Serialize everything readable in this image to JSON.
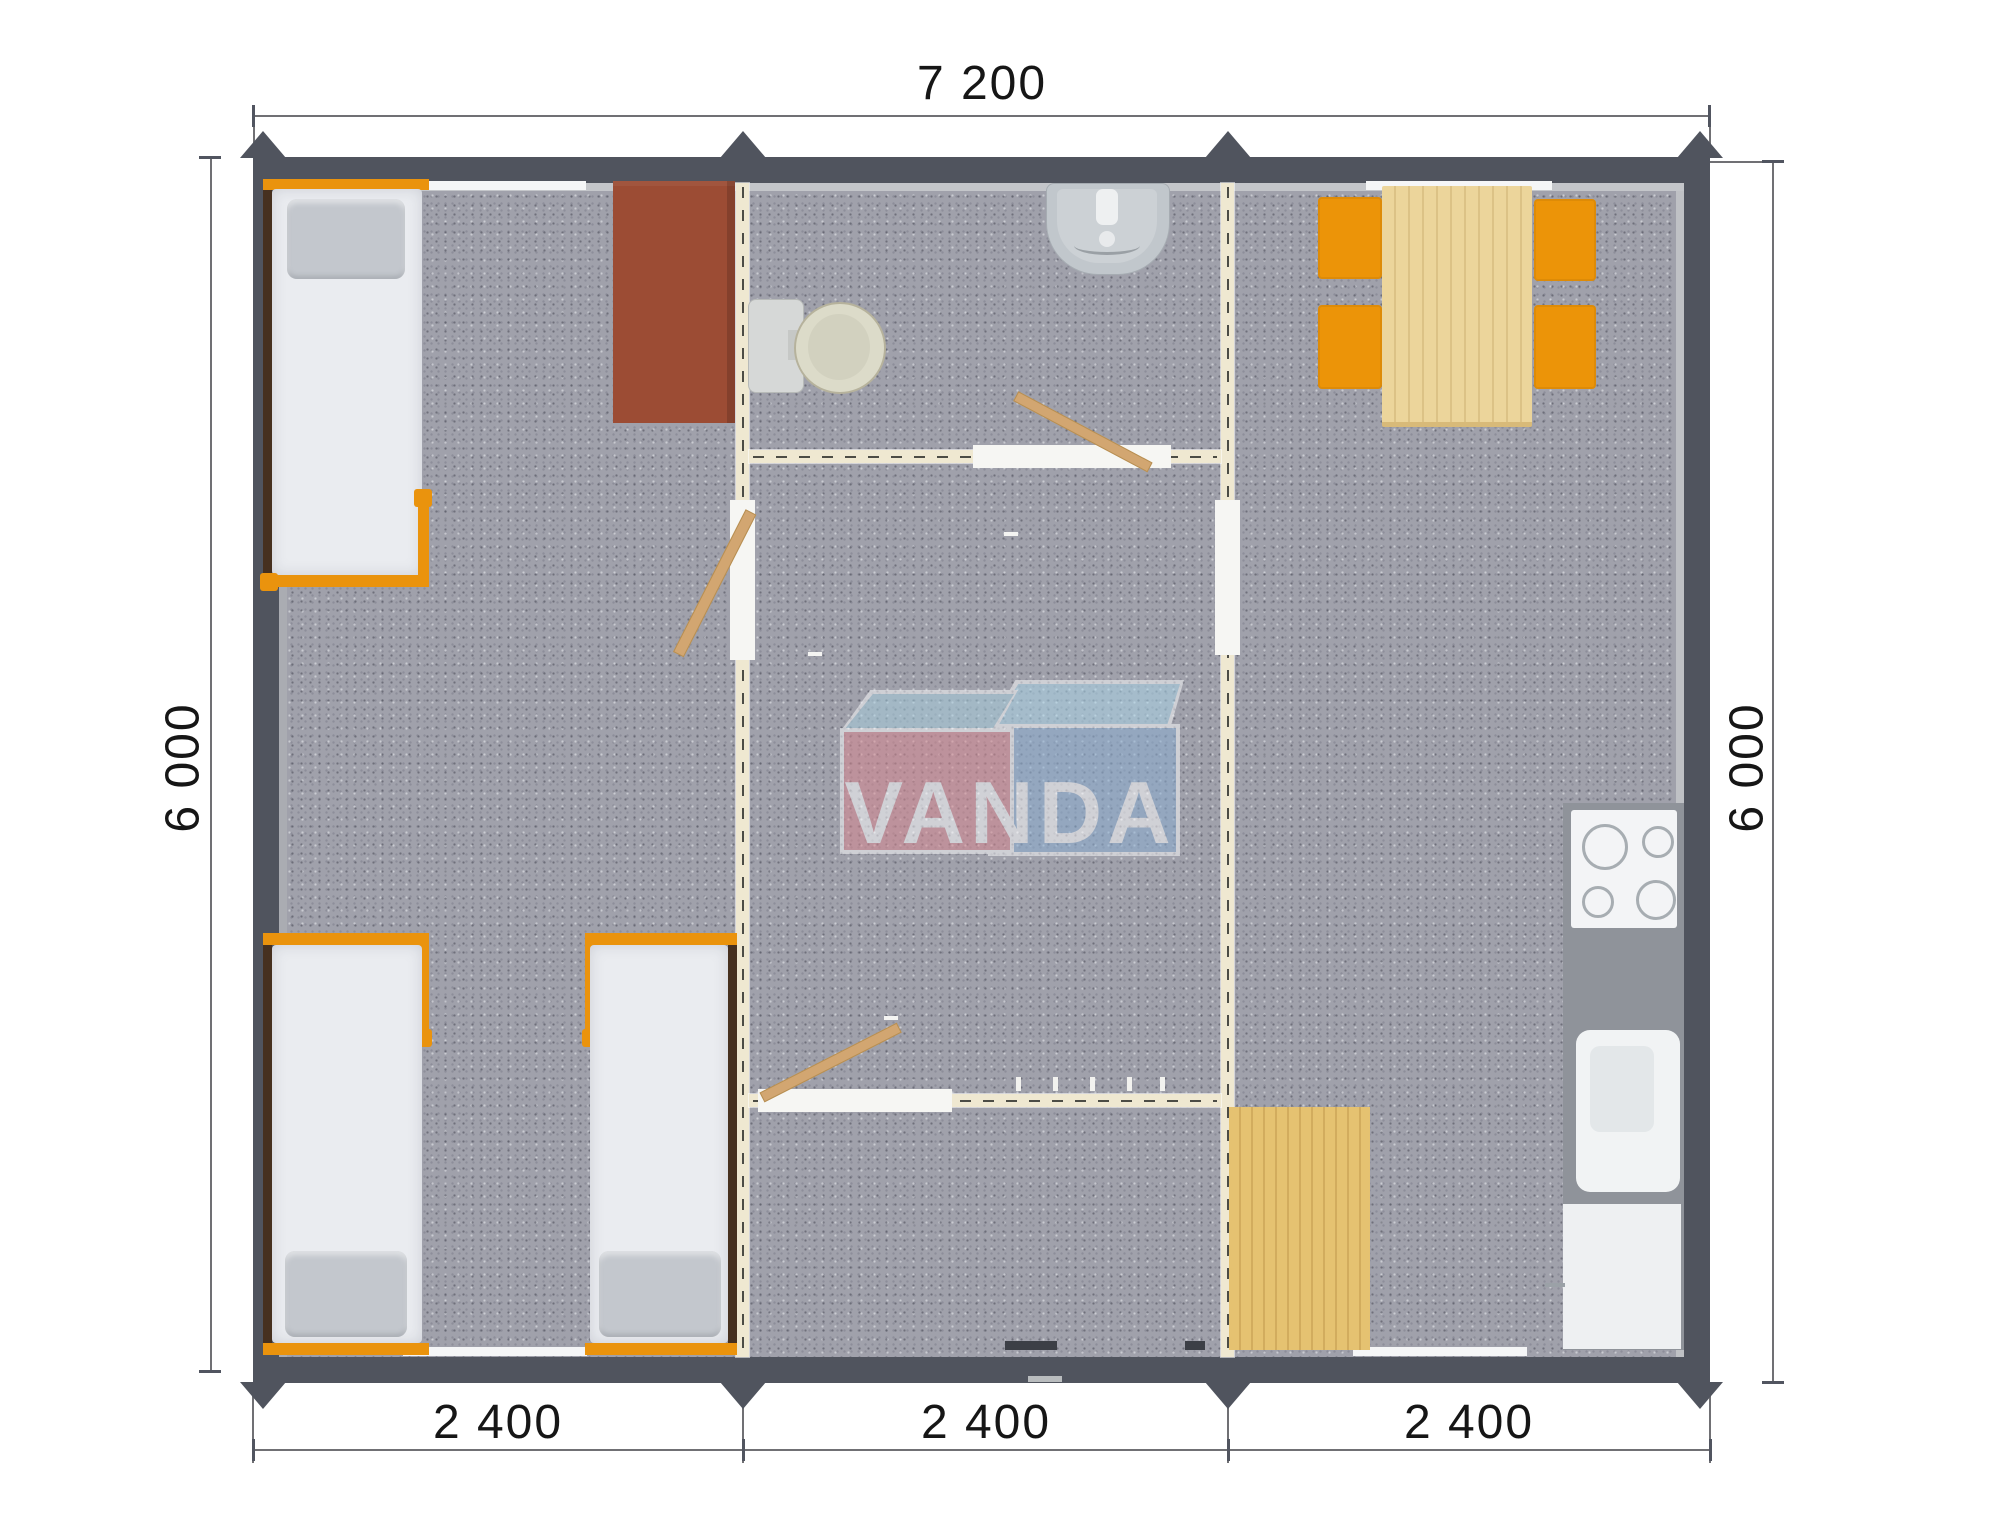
{
  "plan": {
    "brand_logo": {
      "text": "VANDA"
    },
    "dimensions": {
      "top_width": "7 200",
      "left_height": "6 000",
      "right_height": "6 000",
      "bottom_modules": [
        "2 400",
        "2 400",
        "2 400"
      ]
    },
    "modules_count": 3,
    "furniture": [
      "single-bed",
      "single-bed",
      "single-bed",
      "wardrobe",
      "toilet",
      "wash-basin",
      "interior-door",
      "interior-door",
      "interior-door",
      "coat-hooks",
      "dining-table",
      "chair",
      "chair",
      "chair",
      "chair",
      "cooktop",
      "kitchen-sink",
      "fridge",
      "wood-floor-mat"
    ],
    "colors": {
      "wall": "#50545E",
      "partition": "#EFE8D1",
      "carpet": "#A0A1AB",
      "accent_orange": "#EA930D",
      "wood": "#ECD59B",
      "wardrobe_brown": "#9C4C34",
      "logo_pink": "#D8868F",
      "logo_blue": "#8AAED2",
      "logo_light_blue": "#A6CEDE"
    }
  }
}
